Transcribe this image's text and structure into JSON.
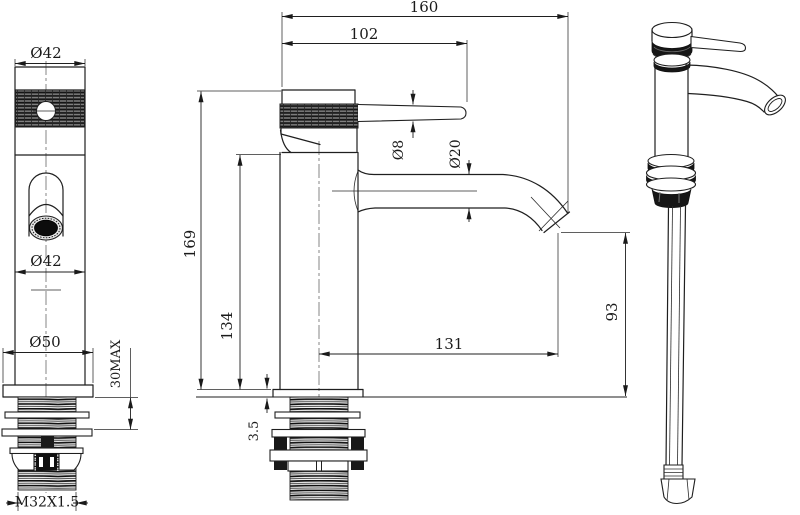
{
  "drawing": {
    "type": "technical-orthographic-drawing",
    "subject": "single-lever basin faucet with mounting shank and supply tube"
  },
  "front_view": {
    "cap_diameter": "Ø42",
    "body_diameter": "Ø42",
    "base_diameter": "Ø50",
    "max_mounting_thickness": "30MAX",
    "thread_spec": "M32X1.5"
  },
  "side_view": {
    "overall_reach": "160",
    "handle_reach": "102",
    "handle_rod_diameter": "Ø8",
    "spout_diameter": "Ø20",
    "overall_height": "169",
    "body_height": "134",
    "spout_reach": "131",
    "spout_clearance": "93",
    "flange_thickness": "3.5"
  },
  "colors": {
    "ink": "#1a1a1a",
    "paper": "#ffffff"
  }
}
